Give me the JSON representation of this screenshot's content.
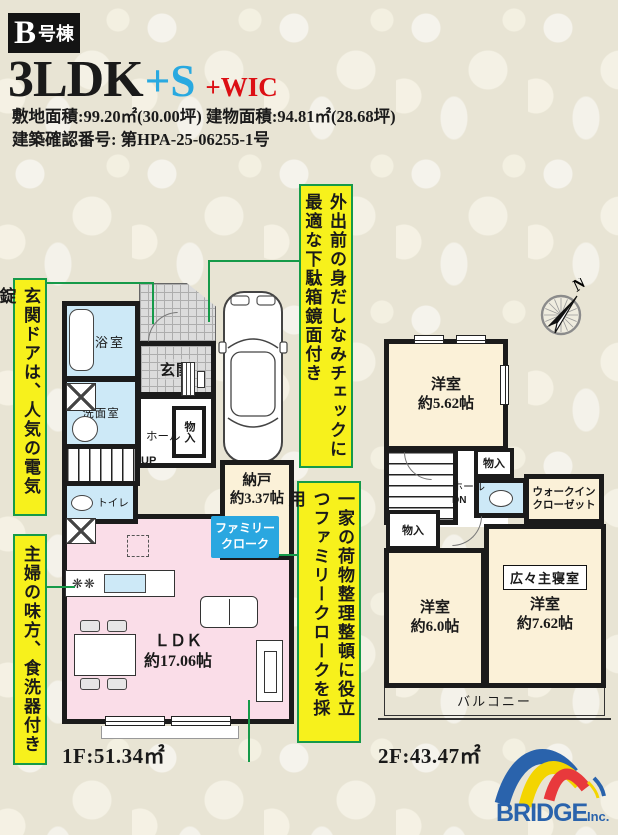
{
  "header": {
    "unit_main": "B",
    "unit_sub": "号棟",
    "plan_main": "3LDK",
    "plan_s": "+S",
    "plan_wic": "+WIC",
    "site_area": "敷地面積:99.20㎡(30.00坪) 建物面積:94.81㎡(28.68坪)",
    "confirmation": "建築確認番号: 第HPA-25-06255-1号"
  },
  "callouts": {
    "mirror": "外出前の身だしなみチェックに最適な下駄箱鏡面付き",
    "door_lock": "玄関ドアは、人気の電気錠",
    "dishwasher": "主婦の味方、食洗器付き",
    "family_cloak": "一家の荷物整理整頓に役立つファミリークロークを採用"
  },
  "floor1": {
    "area_label": "1F:51.34㎡",
    "bath": "浴室",
    "washroom": "洗面室",
    "entrance": "玄関",
    "hall": "ホール",
    "storage": "物入",
    "up": "UP",
    "toilet": "トイレ",
    "nando_name": "納戸",
    "nando_size": "約3.37帖",
    "cloak_line1": "ファミリー",
    "cloak_line2": "クローク",
    "ldk_name": "ＬＤＫ",
    "ldk_size": "約17.06帖"
  },
  "floor2": {
    "area_label": "2F:43.47㎡",
    "bedroom1_name": "洋室",
    "bedroom1_size": "約5.62帖",
    "storage_top": "物入",
    "hall": "ホール",
    "down": "DN",
    "wic_line1": "ウォークイン",
    "wic_line2": "クローゼット",
    "storage_left": "物入",
    "bedroom2_name": "洋室",
    "bedroom2_size": "約6.0帖",
    "master_badge": "広々主寝室",
    "bedroom3_name": "洋室",
    "bedroom3_size": "約7.62帖",
    "balcony": "バルコニー"
  },
  "icons": {
    "stove": "❋❋"
  },
  "compass": {
    "north": "N"
  },
  "logo": {
    "brand": "BRIDGE",
    "suffix": "Inc."
  },
  "colors": {
    "callout_bg": "#f7f11c",
    "callout_border": "#169a49",
    "accent_cyan": "#29a9e0",
    "accent_red": "#dc0f14",
    "room_pink": "#fadde8",
    "room_cream": "#fbf1d8",
    "room_blue": "#cde9f7",
    "cloak_blue": "#2aa7e0",
    "logo_blue": "#2a63ac",
    "logo_yellow": "#f3d500",
    "logo_red": "#e8393c"
  }
}
